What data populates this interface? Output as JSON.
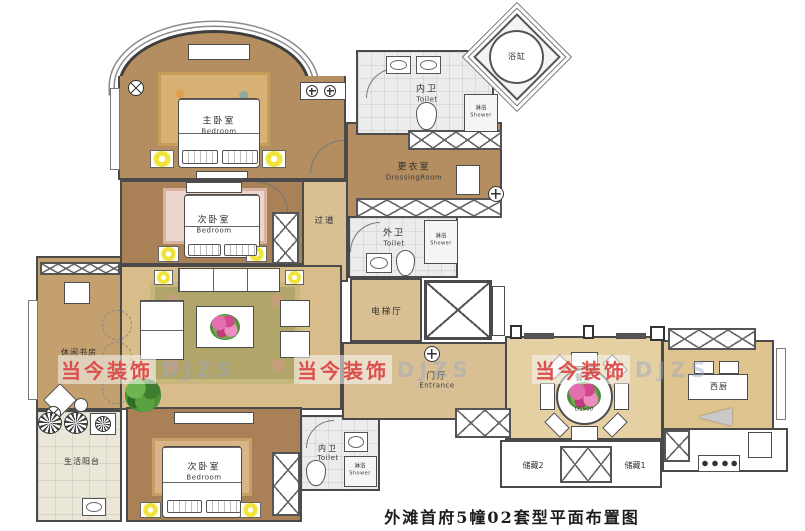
{
  "title": "外滩首府5幢02套型平面布置图",
  "watermark": {
    "text": "当今装饰",
    "ghost": "DJZS"
  },
  "colors": {
    "wall": "#4a4a4a",
    "wood_dark": "#aa8156",
    "wood_mid": "#b48e60",
    "wood_light": "#d9c094",
    "living_floor": "#d8bc8a",
    "dining_floor": "#e4d0a3",
    "tile": "#ececec",
    "watermark_red": "#dc4f4c",
    "lamp_yellow": "#f0e33a"
  },
  "rooms": [
    {
      "id": "master-bedroom",
      "label": "主卧室",
      "label_en": "Bedroom"
    },
    {
      "id": "bedroom-2",
      "label": "次卧室",
      "label_en": "Bedroom"
    },
    {
      "id": "corridor",
      "label": "过道",
      "label_en": ""
    },
    {
      "id": "dressing-room",
      "label": "更衣室",
      "label_en": "DressingRoom"
    },
    {
      "id": "toilet-top",
      "label": "内卫",
      "label_en": "Toilet"
    },
    {
      "id": "bathtub",
      "label": "浴缸",
      "label_en": ""
    },
    {
      "id": "shower-top",
      "label": "淋浴",
      "label_en": "Shower"
    },
    {
      "id": "toilet-mid",
      "label": "外卫",
      "label_en": "Toilet"
    },
    {
      "id": "shower-mid",
      "label": "淋浴",
      "label_en": "Shower"
    },
    {
      "id": "elevator-hall",
      "label": "电梯厅",
      "label_en": ""
    },
    {
      "id": "entrance",
      "label": "门厅",
      "label_en": "Entrance"
    },
    {
      "id": "study",
      "label": "休闲书房",
      "label_en": ""
    },
    {
      "id": "balcony",
      "label": "生活阳台",
      "label_en": ""
    },
    {
      "id": "bedroom-3",
      "label": "次卧室",
      "label_en": "Bedroom"
    },
    {
      "id": "toilet-bottom",
      "label": "内卫",
      "label_en": "Toilet"
    },
    {
      "id": "shower-bottom",
      "label": "淋浴",
      "label_en": "Shower"
    },
    {
      "id": "dining-room",
      "label": "餐厅",
      "label_en": "",
      "note": "D1500"
    },
    {
      "id": "storage-2",
      "label": "储藏2",
      "label_en": ""
    },
    {
      "id": "storage-1",
      "label": "储藏1",
      "label_en": ""
    },
    {
      "id": "west-kitchen",
      "label": "西厨",
      "label_en": ""
    }
  ]
}
